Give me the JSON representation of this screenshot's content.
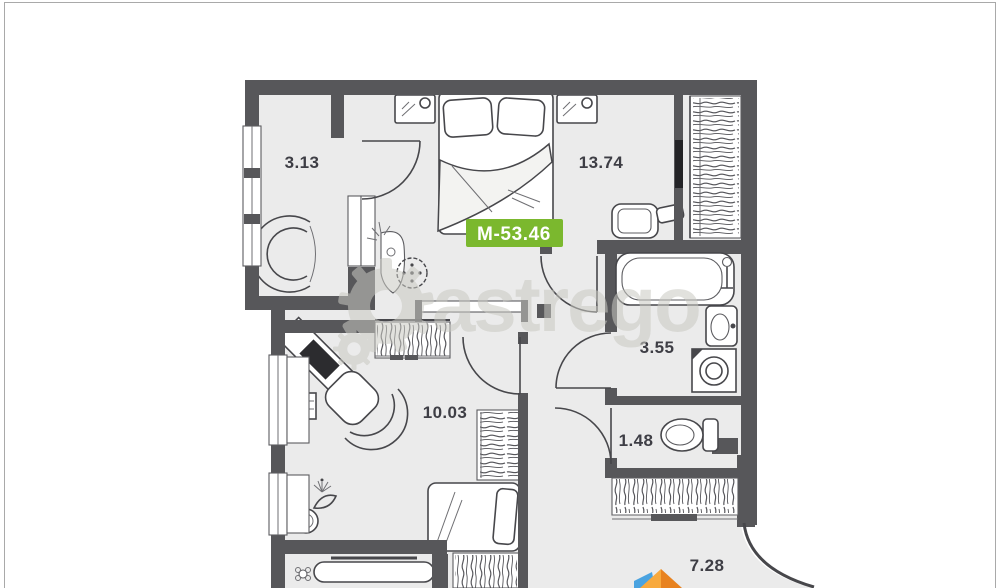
{
  "watermark": {
    "text": "astrego"
  },
  "badge": {
    "label": "М-53.46"
  },
  "rooms": {
    "loggia": {
      "area": "3.13"
    },
    "bedroom": {
      "area": "13.74"
    },
    "bathroom": {
      "area": "3.55"
    },
    "wc": {
      "area": "1.48"
    },
    "living": {
      "area": "10.03"
    },
    "balcony": {
      "area": "7.28"
    }
  },
  "colors": {
    "badge_green": "#7bb82e",
    "wall_gray": "#57575a",
    "floor_gray": "#ebebeb",
    "watermark_gray": "#c9c9c2",
    "logo_blue": "#4aa3e0",
    "logo_orange": "#f8a93c",
    "logo_orange_dark": "#e8821f"
  }
}
